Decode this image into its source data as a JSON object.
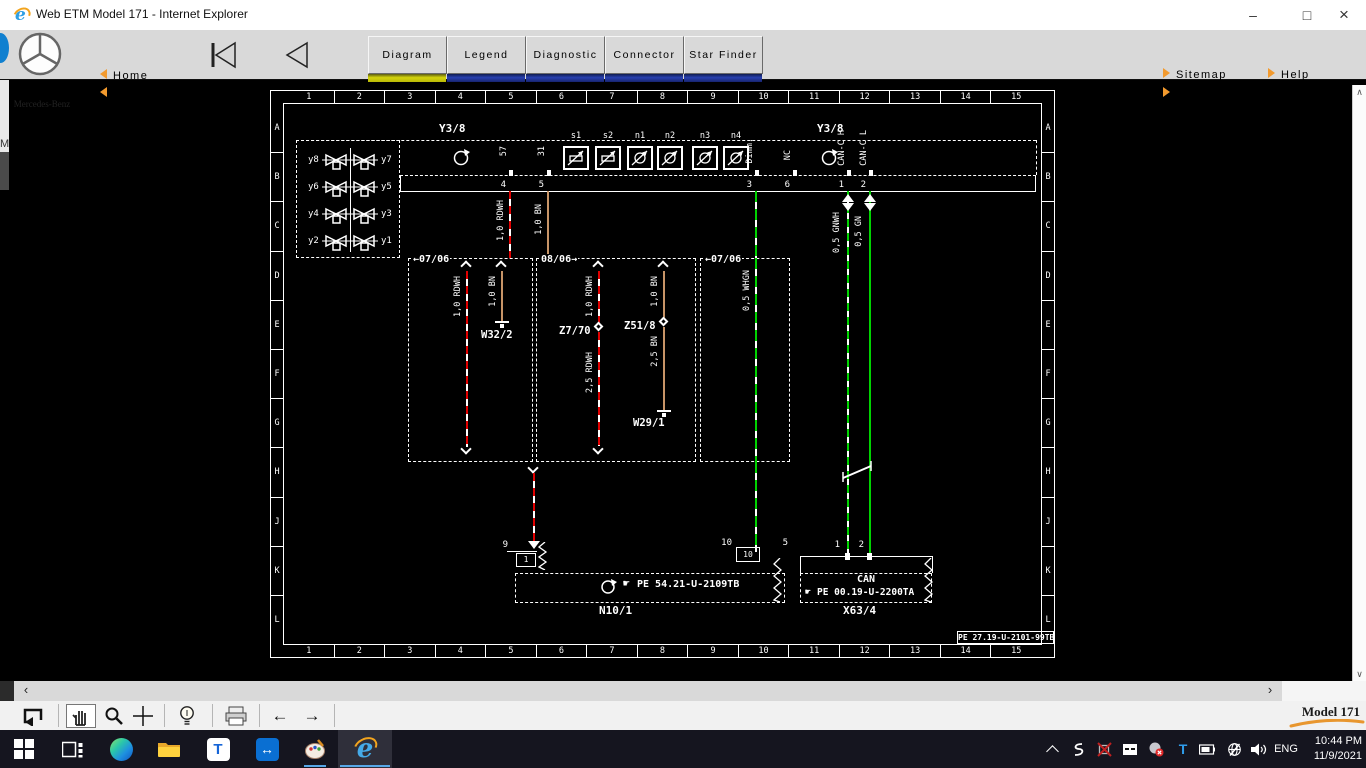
{
  "window": {
    "title": "Web ETM Model 171 - Internet Explorer",
    "controls": {
      "minimize": "–",
      "maximize": "□",
      "close": "×"
    }
  },
  "background": {
    "edge_sliver": "M"
  },
  "toolbar": {
    "brand": "Mercedes-Benz",
    "home": "Home",
    "back": "Back",
    "tabs": [
      "Diagram",
      "Legend",
      "Diagnostic",
      "Connector",
      "Star Finder"
    ],
    "active_tab": "Diagram",
    "sitemap": "Sitemap",
    "help": "Help",
    "abbreviation": "Abbreviation",
    "accent_orange": "#f29a2e",
    "tab_active_underline": "#d4d40a",
    "tab_underline": "#2840b0"
  },
  "diagram": {
    "cols": [
      "1",
      "2",
      "3",
      "4",
      "5",
      "6",
      "7",
      "8",
      "9",
      "10",
      "11",
      "12",
      "13",
      "14",
      "15"
    ],
    "rows": [
      "A",
      "B",
      "C",
      "D",
      "E",
      "F",
      "G",
      "H",
      "J",
      "K",
      "L"
    ],
    "component": {
      "label_left": "Y3/8",
      "label_right": "Y3/8",
      "valves_left": [
        "y8",
        "y6",
        "y4",
        "y2"
      ],
      "valves_right": [
        "y7",
        "y5",
        "y3",
        "y1"
      ],
      "cells": [
        "s1",
        "s2",
        "n1",
        "n2",
        "n3",
        "n4"
      ]
    },
    "pins": [
      {
        "n": "4",
        "sig": "57"
      },
      {
        "n": "5",
        "sig": "31"
      },
      {
        "n": "3",
        "sig": "Dimm."
      },
      {
        "n": "6",
        "sig": "NC"
      },
      {
        "n": "1",
        "sig": "CAN-C H"
      },
      {
        "n": "2",
        "sig": "CAN-C L"
      }
    ],
    "wires": {
      "rdwh_top": "1,0 RDWH",
      "bn_top": "1,0 BN",
      "gnwh": "0,5 GNWH",
      "gn": "0,5 GN",
      "box1_rd": "1,0 RDWH",
      "box1_bn": "1,0 BN",
      "box2_rd": "1,0 RDWH",
      "box2_rd2": "2,5 RDWH",
      "box2_bn": "1,0 BN",
      "box2_bn2": "2,5 BN",
      "box3_w": "0,5 WHGN"
    },
    "boxes": {
      "box1_date": "←07/06",
      "box2_date": "08/06→",
      "box3_date": "←07/06"
    },
    "grounds": {
      "g1": "W32/2",
      "g2": "W29/1"
    },
    "splices": {
      "s1": "Z7/70",
      "s2": "Z51/8"
    },
    "n10": {
      "pin_out": "9",
      "pin_in": "1",
      "pin2_out": "10",
      "pin2_in": "10",
      "hand": "☛",
      "ref": "PE  54.21-U-2109TB",
      "name": "N10/1"
    },
    "x63": {
      "pin_out": "5",
      "pin1": "1",
      "pin2": "2",
      "bus": "CAN",
      "hand": "☛",
      "ref": "PE 00.19-U-2200TA",
      "name": "X63/4"
    },
    "footer_ref": "PE 27.19-U-2101-99TB",
    "colors": {
      "red": "#e10000",
      "brown": "#c79467",
      "green": "#00d300"
    }
  },
  "scrollbar": {
    "left": "‹",
    "right": "›",
    "up": "∧",
    "down": "∨"
  },
  "toolrow": {
    "model": "Model 171"
  },
  "taskbar": {
    "tray": {
      "lang": "ENG",
      "time": "10:44 PM",
      "date": "11/9/2021"
    }
  }
}
